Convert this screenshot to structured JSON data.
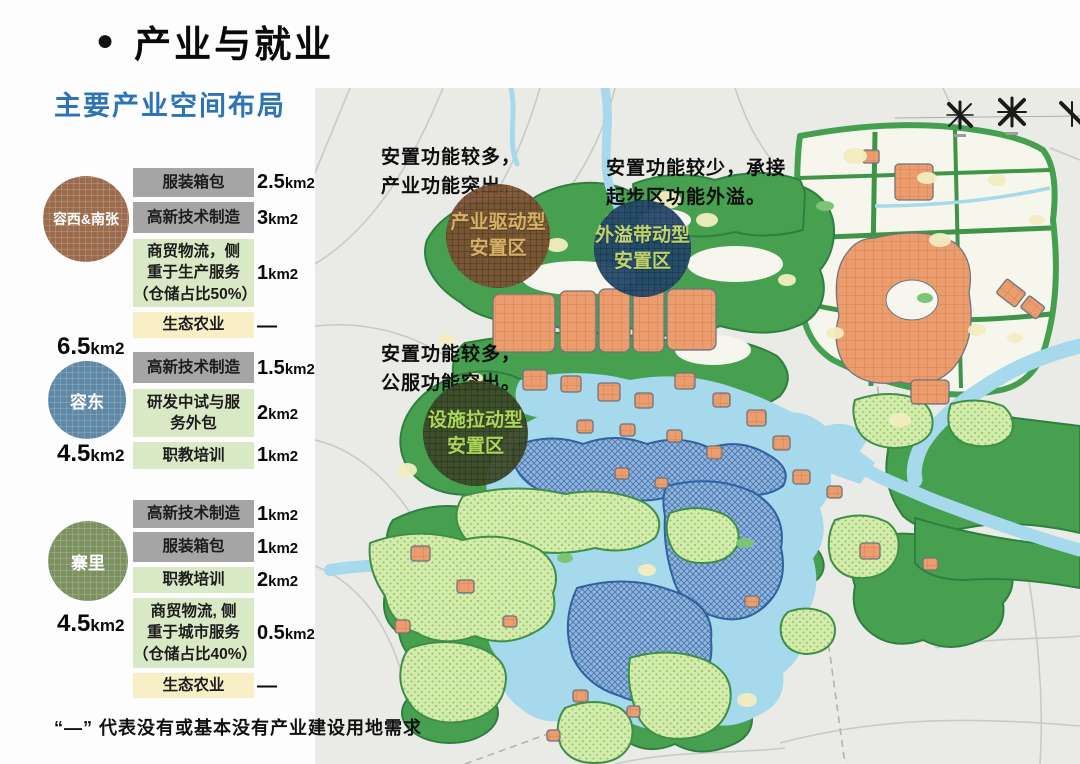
{
  "header": {
    "bullet": "●",
    "title": "产业与就业",
    "subtitle": "主要产业空间布局"
  },
  "panel": {
    "groups": [
      {
        "name": "容西&南张",
        "total_num": "6.5",
        "total_unit": "km2",
        "rows": [
          {
            "label": "服装箱包",
            "num": "2.5",
            "unit": "km2"
          },
          {
            "label": "高新技术制造",
            "num": "3",
            "unit": "km2"
          },
          {
            "label": "商贸物流，侧\n重于生产服务\n（仓储占比50%）",
            "num": "1",
            "unit": "km2"
          },
          {
            "label": "生态农业",
            "num": "—",
            "unit": ""
          }
        ]
      },
      {
        "name": "容东",
        "total_num": "4.5",
        "total_unit": "km2",
        "rows": [
          {
            "label": "高新技术制造",
            "num": "1.5",
            "unit": "km2"
          },
          {
            "label": "研发中试与服\n务外包",
            "num": "2",
            "unit": "km2"
          },
          {
            "label": "职教培训",
            "num": "1",
            "unit": "km2"
          }
        ]
      },
      {
        "name": "寨里",
        "total_num": "4.5",
        "total_unit": "km2",
        "rows": [
          {
            "label": "高新技术制造",
            "num": "1",
            "unit": "km2"
          },
          {
            "label": "服装箱包",
            "num": "1",
            "unit": "km2"
          },
          {
            "label": "职教培训",
            "num": "2",
            "unit": "km2"
          },
          {
            "label": "商贸物流, 侧\n重于城市服务\n（仓储占比40%）",
            "num": "0.5",
            "unit": "km2"
          },
          {
            "label": "生态农业",
            "num": "—",
            "unit": ""
          }
        ]
      }
    ]
  },
  "map": {
    "annotations": [
      {
        "text": "安置功能较多，\n产业功能突出。"
      },
      {
        "text": "安置功能较少，承接\n起步区功能外溢。"
      },
      {
        "text": "安置功能较多，\n公服功能突出。"
      }
    ],
    "zones": [
      {
        "label": "产业驱动型\n安置区"
      },
      {
        "label": "外溢带动型\n安置区"
      },
      {
        "label": "设施拉动型\n安置区"
      }
    ]
  },
  "footer": {
    "note": "“—” 代表没有或基本没有产业建设用地需求"
  },
  "colors": {
    "subtitle_blue": "#2e74b5",
    "group_circle_brown": "#9a6b4c",
    "group_circle_blue": "#5f88a6",
    "group_circle_olive": "#7d9060",
    "zone_brown": "#7c5233",
    "zone_navy": "#24476b",
    "zone_olive": "#3d4a28",
    "zone_brown_text": "#e0b267",
    "zone_navy_text": "#c6d66b",
    "zone_olive_text": "#b2d95c",
    "box_gray": "#a5a5a5",
    "box_green": "#d9e9c5",
    "box_yellow": "#f8efc6"
  }
}
